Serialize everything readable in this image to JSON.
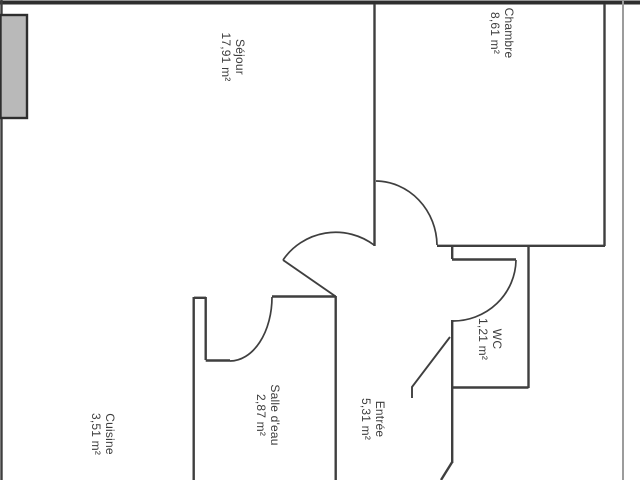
{
  "floorplan": {
    "rooms": {
      "sejour": {
        "name": "Séjour",
        "area": "17,91 m²"
      },
      "chambre": {
        "name": "Chambre",
        "area": "8,61 m²"
      },
      "wc": {
        "name": "WC",
        "area": "1,21 m²"
      },
      "salle_deau": {
        "name": "Salle d'eau",
        "area": "2,87 m²"
      },
      "entree": {
        "name": "Entrée",
        "area": "5,31 m²"
      },
      "cuisine": {
        "name": "Cuisine",
        "area": "3,51 m²"
      }
    },
    "colors": {
      "background": "#ffffff",
      "wall": "#3f3f3f",
      "exterior_wall": "#2e2e2e",
      "light_boundary_line": "#9c9c9c",
      "balcony_fill": "#b9b9b9",
      "label_text": "#3d3d3d"
    }
  }
}
